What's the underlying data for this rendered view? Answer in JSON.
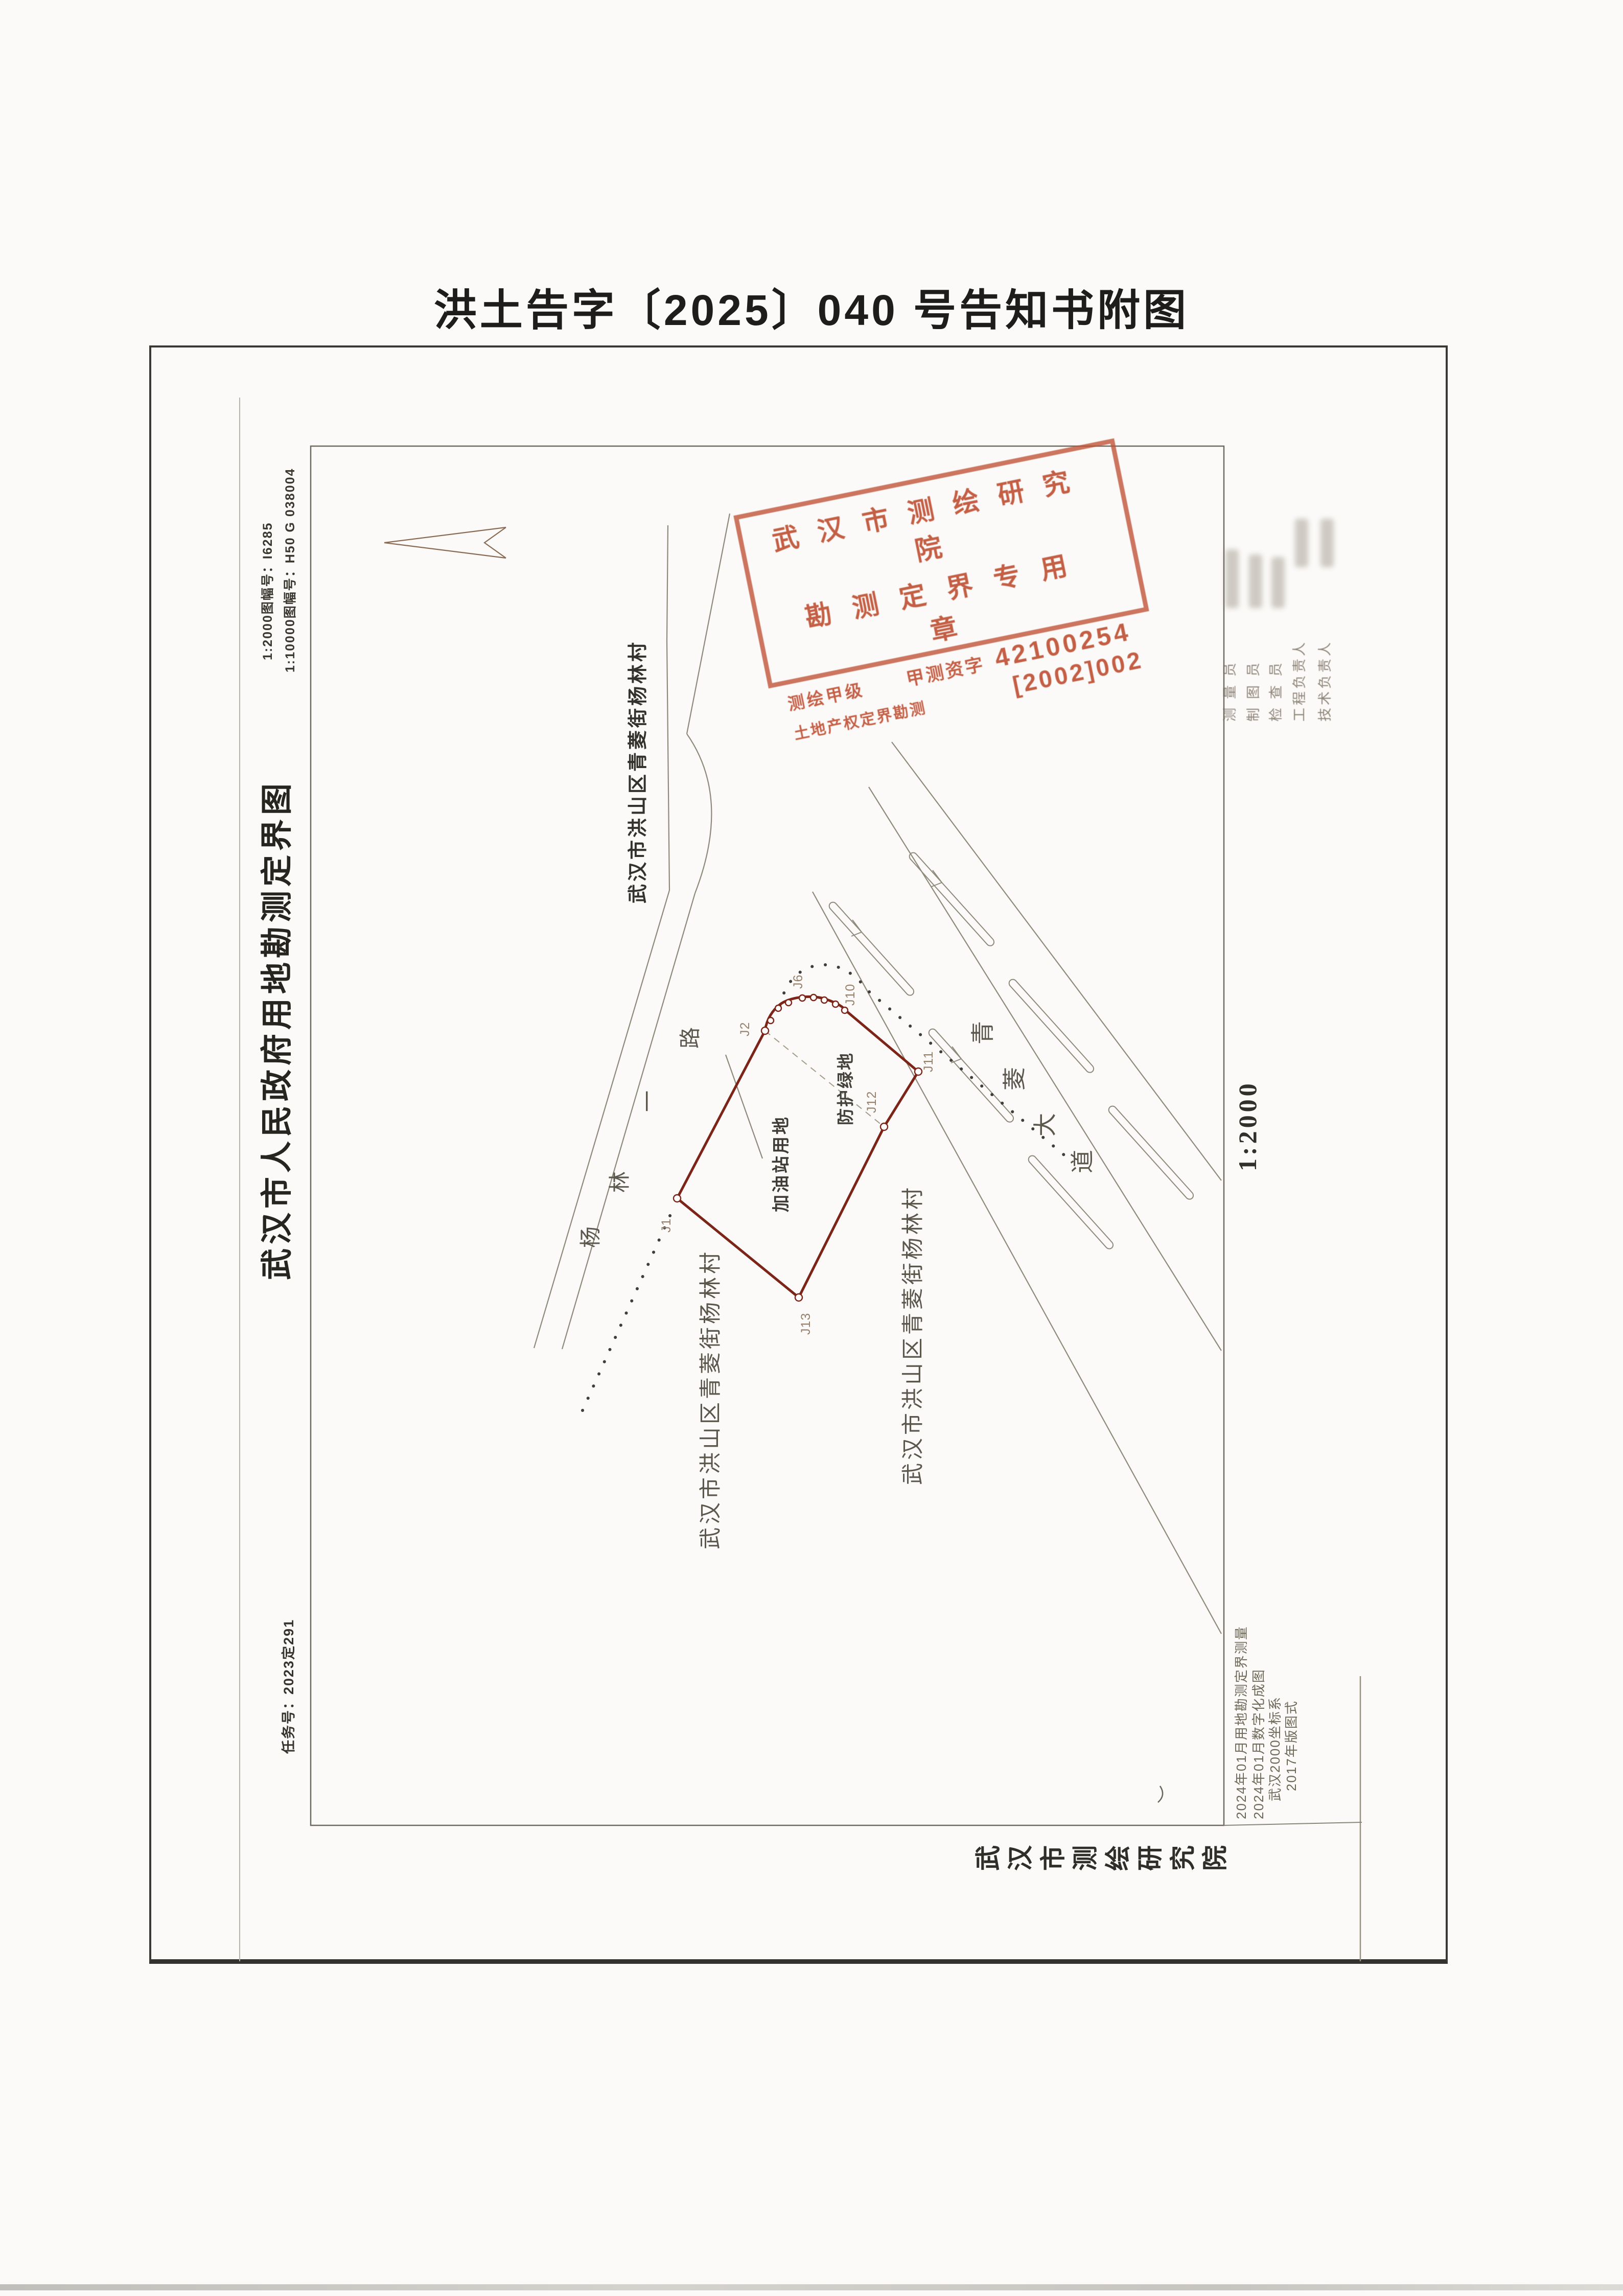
{
  "page": {
    "title": "洪土告字〔2025〕040 号告知书附图"
  },
  "margin": {
    "map_title": "武汉市人民政府用地勘测定界图",
    "task_no": "任务号：2023定291",
    "sheet_no_1": "1:2000图幅号：I6285",
    "sheet_no_2": "1:10000图幅号：H50 G 038004",
    "scale_text": "1:2000",
    "publisher_chars": [
      "武",
      "汉",
      "市",
      "测",
      "绘",
      "研",
      "究",
      "院"
    ]
  },
  "stamp": {
    "line1": "武汉市测绘研究院",
    "line2": "勘测定界专用章",
    "grade": "测绘甲级",
    "cert_label": "甲测资字",
    "cert_no": "42100254",
    "bottom_label": "土地产权定界勘测",
    "bottom_no": "[2002]002",
    "color": "#bf5438"
  },
  "map": {
    "parcel_label": "加油站用地",
    "green_belt_label": "防护绿地",
    "village_top": "武汉市洪山区青菱街杨林村",
    "village_left": "武汉市洪山区青菱街杨林村",
    "village_right": "武汉市洪山区青菱街杨林村",
    "road_yanglin_chars": [
      "杨",
      "林",
      "一",
      "路"
    ],
    "road_qingling_chars": [
      "青",
      "菱",
      "大",
      "道"
    ],
    "vertex_labels": {
      "j1": "J1",
      "j2": "J2",
      "j6": "J6",
      "j10": "J10",
      "j11": "J11",
      "j12": "J12",
      "j13": "J13"
    },
    "boundary_color": "#7c2418"
  },
  "signatures": {
    "rows": [
      "测量员",
      "制图员",
      "检查员",
      "工程负责人",
      "技术负责人"
    ]
  },
  "notes": {
    "n1": "2024年01月用地勘测定界测量",
    "n2": "2024年01月数字化成图",
    "n3": "武汉2000坐标系",
    "n4": "2017年版图式"
  }
}
